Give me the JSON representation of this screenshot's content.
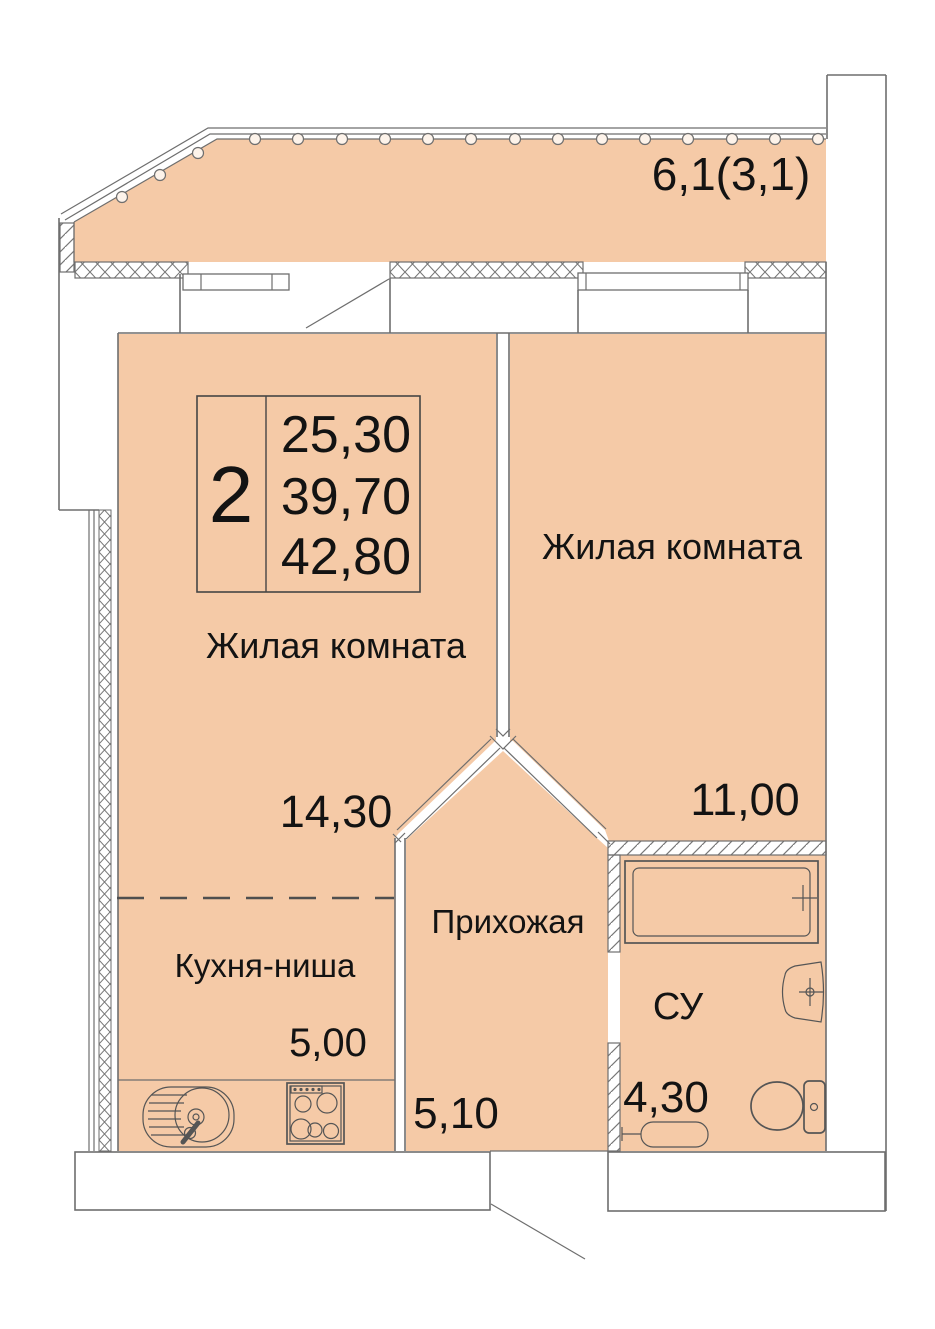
{
  "plan_title": "2-room apartment floor plan",
  "colors": {
    "room_fill": "#f5caa7",
    "wall_line": "#6e6e6e",
    "text": "#131313"
  },
  "balcony": {
    "area": "6,1(3,1)"
  },
  "summary": {
    "rooms_count": "2",
    "living_area": "25,30",
    "apartment_area": "39,70",
    "total_area": "42,80"
  },
  "rooms": {
    "living1": {
      "name": "Жилая комната",
      "area": "14,30"
    },
    "living2": {
      "name": "Жилая комната",
      "area": "11,00"
    },
    "kitchen": {
      "name": "Кухня-ниша",
      "area": "5,00"
    },
    "hallway": {
      "name": "Прихожая",
      "area": "5,10"
    },
    "bathroom": {
      "name": "СУ",
      "area": "4,30"
    }
  }
}
